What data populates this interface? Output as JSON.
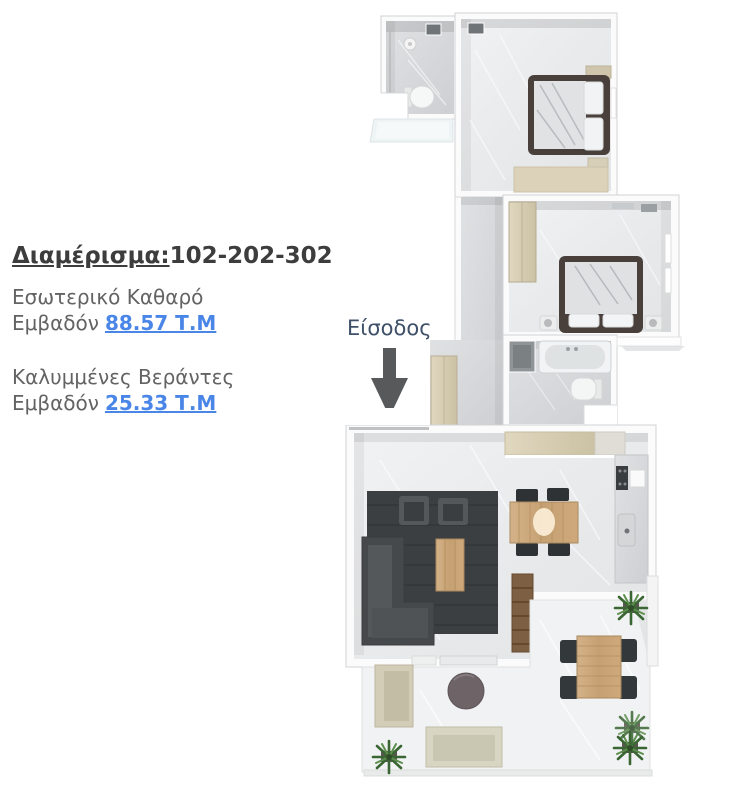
{
  "window": {
    "width": 734,
    "height": 785,
    "background": "#ffffff"
  },
  "info_panel": {
    "title": {
      "label": "Διαμέρισμα:",
      "value": "102-202-302"
    },
    "areas": [
      {
        "line1": "Εσωτερικό Καθαρό",
        "line2_prefix": "Εμβαδόν",
        "value": "88.57 Τ.Μ"
      },
      {
        "line1": "Καλυμμένες Βεράντες",
        "line2_prefix": "Εμβαδόν",
        "value": "25.33 Τ.Μ"
      }
    ],
    "colors": {
      "title": "#3d3d3d",
      "body": "#636363",
      "link": "#4a86e8"
    }
  },
  "entrance": {
    "label": "Είσοδος",
    "label_color": "#3f5169",
    "arrow_color": "#58595b"
  },
  "floorplan": {
    "type": "apartment-3d-top-view",
    "rooms": [
      "bathroom-top",
      "bedroom-top",
      "bedroom-middle",
      "hallway",
      "bathroom-middle",
      "living-room",
      "kitchen",
      "veranda"
    ],
    "palette": {
      "wall": "#fbfbfb",
      "wall_edge": "#d2d3d4",
      "floor_light": "#eceef0",
      "floor_dark": "#d6d8da",
      "rug": "#3c3f41",
      "wood": "#c9a578",
      "cabinet_beige": "#d8cfb6",
      "sofa_dark": "#46494c",
      "bed_frame": "#4a403b",
      "plant_green": "#3e6b34"
    }
  }
}
